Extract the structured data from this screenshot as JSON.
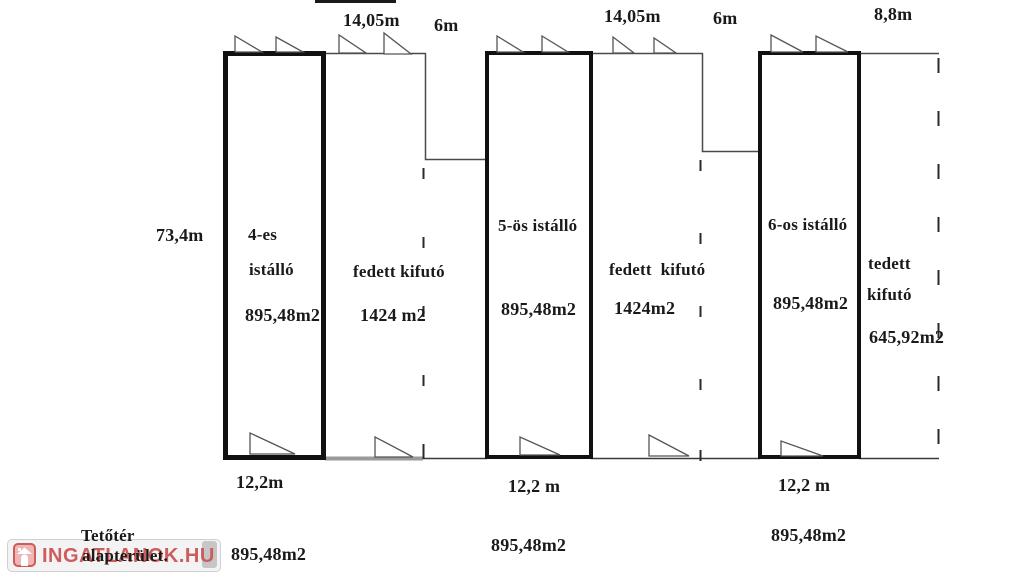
{
  "colors": {
    "ink": "#1a1a1a",
    "thin_line": "#4a4a4a",
    "gray_line": "#9a9a9a",
    "watermark_red": "#cd5c5c",
    "watermark_bg": "#f3f3f3"
  },
  "dimensions": {
    "top": [
      "14,05m",
      "6m",
      "14,05m",
      "6m",
      "8,8m"
    ],
    "left_height": "73,4m",
    "bottom_widths": [
      "12,2m",
      "12,2 m",
      "12,2 m"
    ]
  },
  "units": [
    {
      "id": "stable-4",
      "name_lines": [
        "4-es",
        "istálló"
      ],
      "area": "895,48m2"
    },
    {
      "id": "covered-run-1",
      "name_lines": [
        "fedett kifutó"
      ],
      "area": "1424 m2"
    },
    {
      "id": "stable-5",
      "name_lines": [
        "5-ös istálló"
      ],
      "area": "895,48m2"
    },
    {
      "id": "covered-run-2",
      "name_lines": [
        "fedett  kifutó"
      ],
      "area": "1424m2"
    },
    {
      "id": "stable-6",
      "name_lines": [
        "6-os istálló"
      ],
      "area": "895,48m2"
    },
    {
      "id": "covered-run-3",
      "name_lines": [
        "tedett",
        "kifutó"
      ],
      "area": "645,92m2"
    }
  ],
  "attic": {
    "title_line1": "Tetőtér",
    "title_line2": "alapterület.",
    "areas": [
      "895,48m2",
      "895,48m2",
      "895,48m2"
    ]
  },
  "watermark": {
    "brand": "INGATLANOK.HU"
  }
}
